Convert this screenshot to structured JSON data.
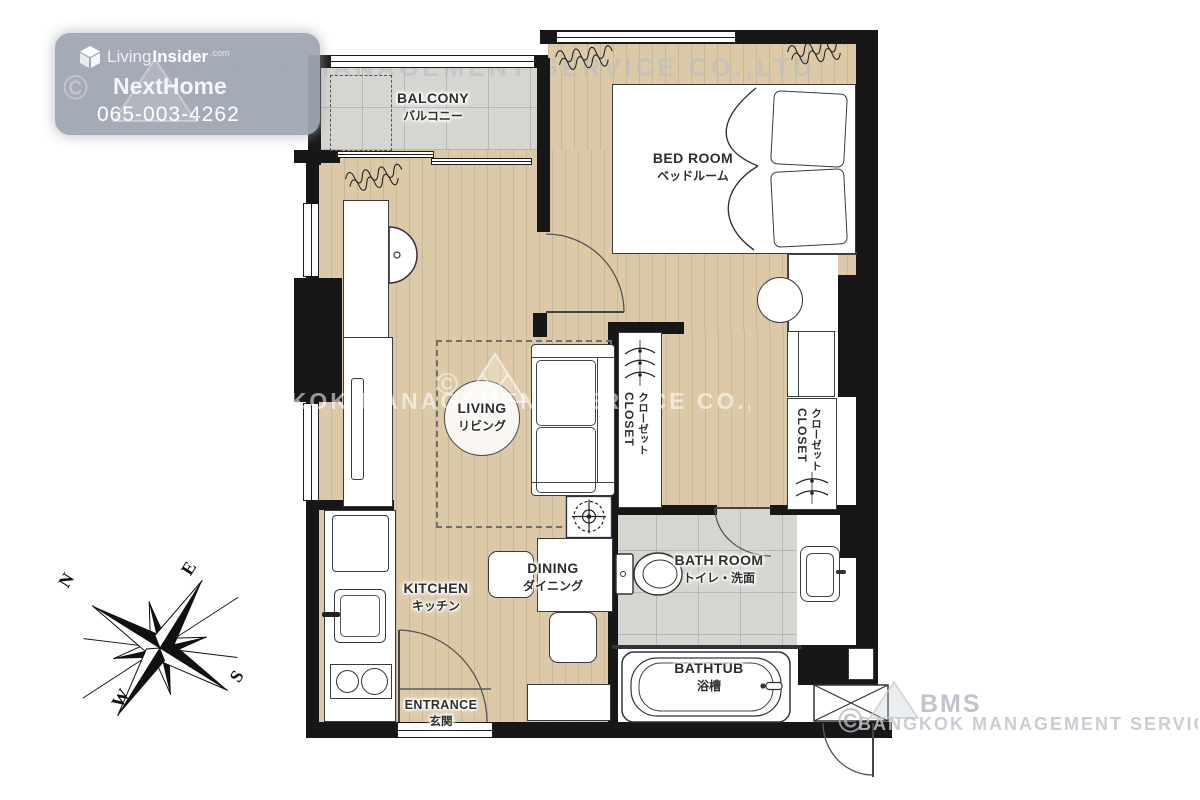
{
  "badge": {
    "brand_prefix": "Living",
    "brand_suffix": "Insider",
    "brand_tld": ".com",
    "agent_name": "NextHome",
    "phone": "065-003-4262"
  },
  "rooms": {
    "balcony": {
      "en": "BALCONY",
      "ja": "バルコニー"
    },
    "bedroom": {
      "en": "BED ROOM",
      "ja": "ベッドルーム"
    },
    "living": {
      "en": "LIVING",
      "ja": "リビング"
    },
    "dining": {
      "en": "DINING",
      "ja": "ダイニング"
    },
    "kitchen": {
      "en": "KITCHEN",
      "ja": "キッチン"
    },
    "entrance": {
      "en": "ENTRANCE",
      "ja": "玄関"
    },
    "bathroom": {
      "en": "BATH ROOM",
      "ja": "トイレ・洗面"
    },
    "bathtub": {
      "en": "BATHTUB",
      "ja": "浴槽"
    },
    "closet_left": {
      "en": "CLOSET",
      "ja": "クローゼット"
    },
    "closet_right": {
      "en": "CLOSET",
      "ja": "クローゼット"
    }
  },
  "compass": {
    "n": "N",
    "e": "E",
    "s": "S",
    "w": "W"
  },
  "watermarks": {
    "service_top": "BANGKOK MANAGEMENT SERVICE CO.,LTD",
    "service_mid": "BANGKOK MANAGEMENT SERVICE CO.,LTD",
    "service_bottom": "BANGKOK MANAGEMENT SERVICE CO.,LTD",
    "bms": "BMS",
    "copyright": "©"
  },
  "colors": {
    "wall": "#171717",
    "wood_floor": "#dcc9a8",
    "tile_floor": "#d7d5d0",
    "badge_bg": "#a0a6b2",
    "line": "#3a3a3a"
  }
}
